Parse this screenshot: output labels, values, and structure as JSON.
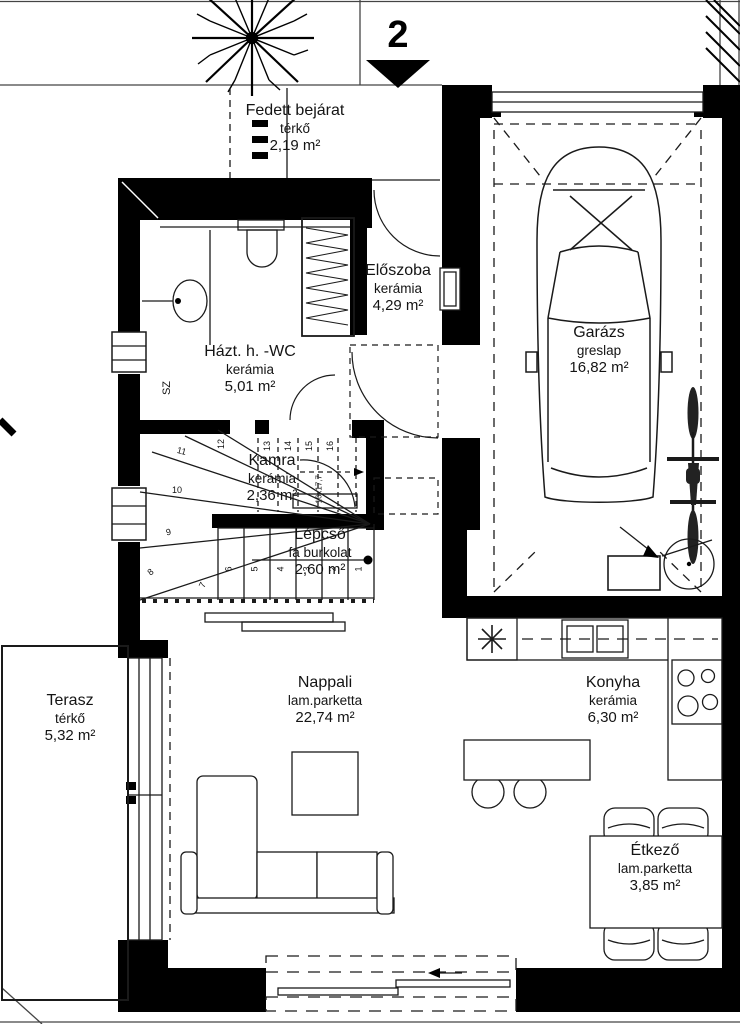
{
  "plan": {
    "title": "Emeleti alaprajz",
    "level_marker": "2",
    "rooms": {
      "fedett_bejarat": {
        "name": "Fedett bejárat",
        "finish": "térkő",
        "area": "2,19 m²"
      },
      "eloszoba": {
        "name": "Előszoba",
        "finish": "kerámia",
        "area": "4,29 m²"
      },
      "hazt_wc": {
        "name": "Házt. h. -WC",
        "finish": "kerámia",
        "area": "5,01 m²"
      },
      "kamra": {
        "name": "Kamra",
        "finish": "kerámia",
        "area": "2,36 m²"
      },
      "lepcso": {
        "name": "Lépcső",
        "finish": "fa burkolat",
        "area": "2,60 m²"
      },
      "garazs": {
        "name": "Garázs",
        "finish": "greslap",
        "area": "16,82 m²"
      },
      "terasz": {
        "name": "Terasz",
        "finish": "térkő",
        "area": "5,32 m²"
      },
      "nappali": {
        "name": "Nappali",
        "finish": "lam.parketta",
        "area": "22,74 m²"
      },
      "konyha": {
        "name": "Konyha",
        "finish": "kerámia",
        "area": "6,30 m²"
      },
      "etkezo": {
        "name": "Étkező",
        "finish": "lam.parketta",
        "area": "3,85 m²"
      }
    },
    "stairs": {
      "numbers": [
        "1",
        "2",
        "3",
        "4",
        "5",
        "6",
        "7",
        "8",
        "9",
        "10",
        "11",
        "12",
        "13",
        "14",
        "15",
        "16"
      ],
      "annotation": "16x17,7"
    },
    "labels": {
      "shaft": "SZ"
    },
    "colors": {
      "wall": "#000000",
      "line": "#1a1a1a",
      "background": "#ffffff"
    }
  }
}
